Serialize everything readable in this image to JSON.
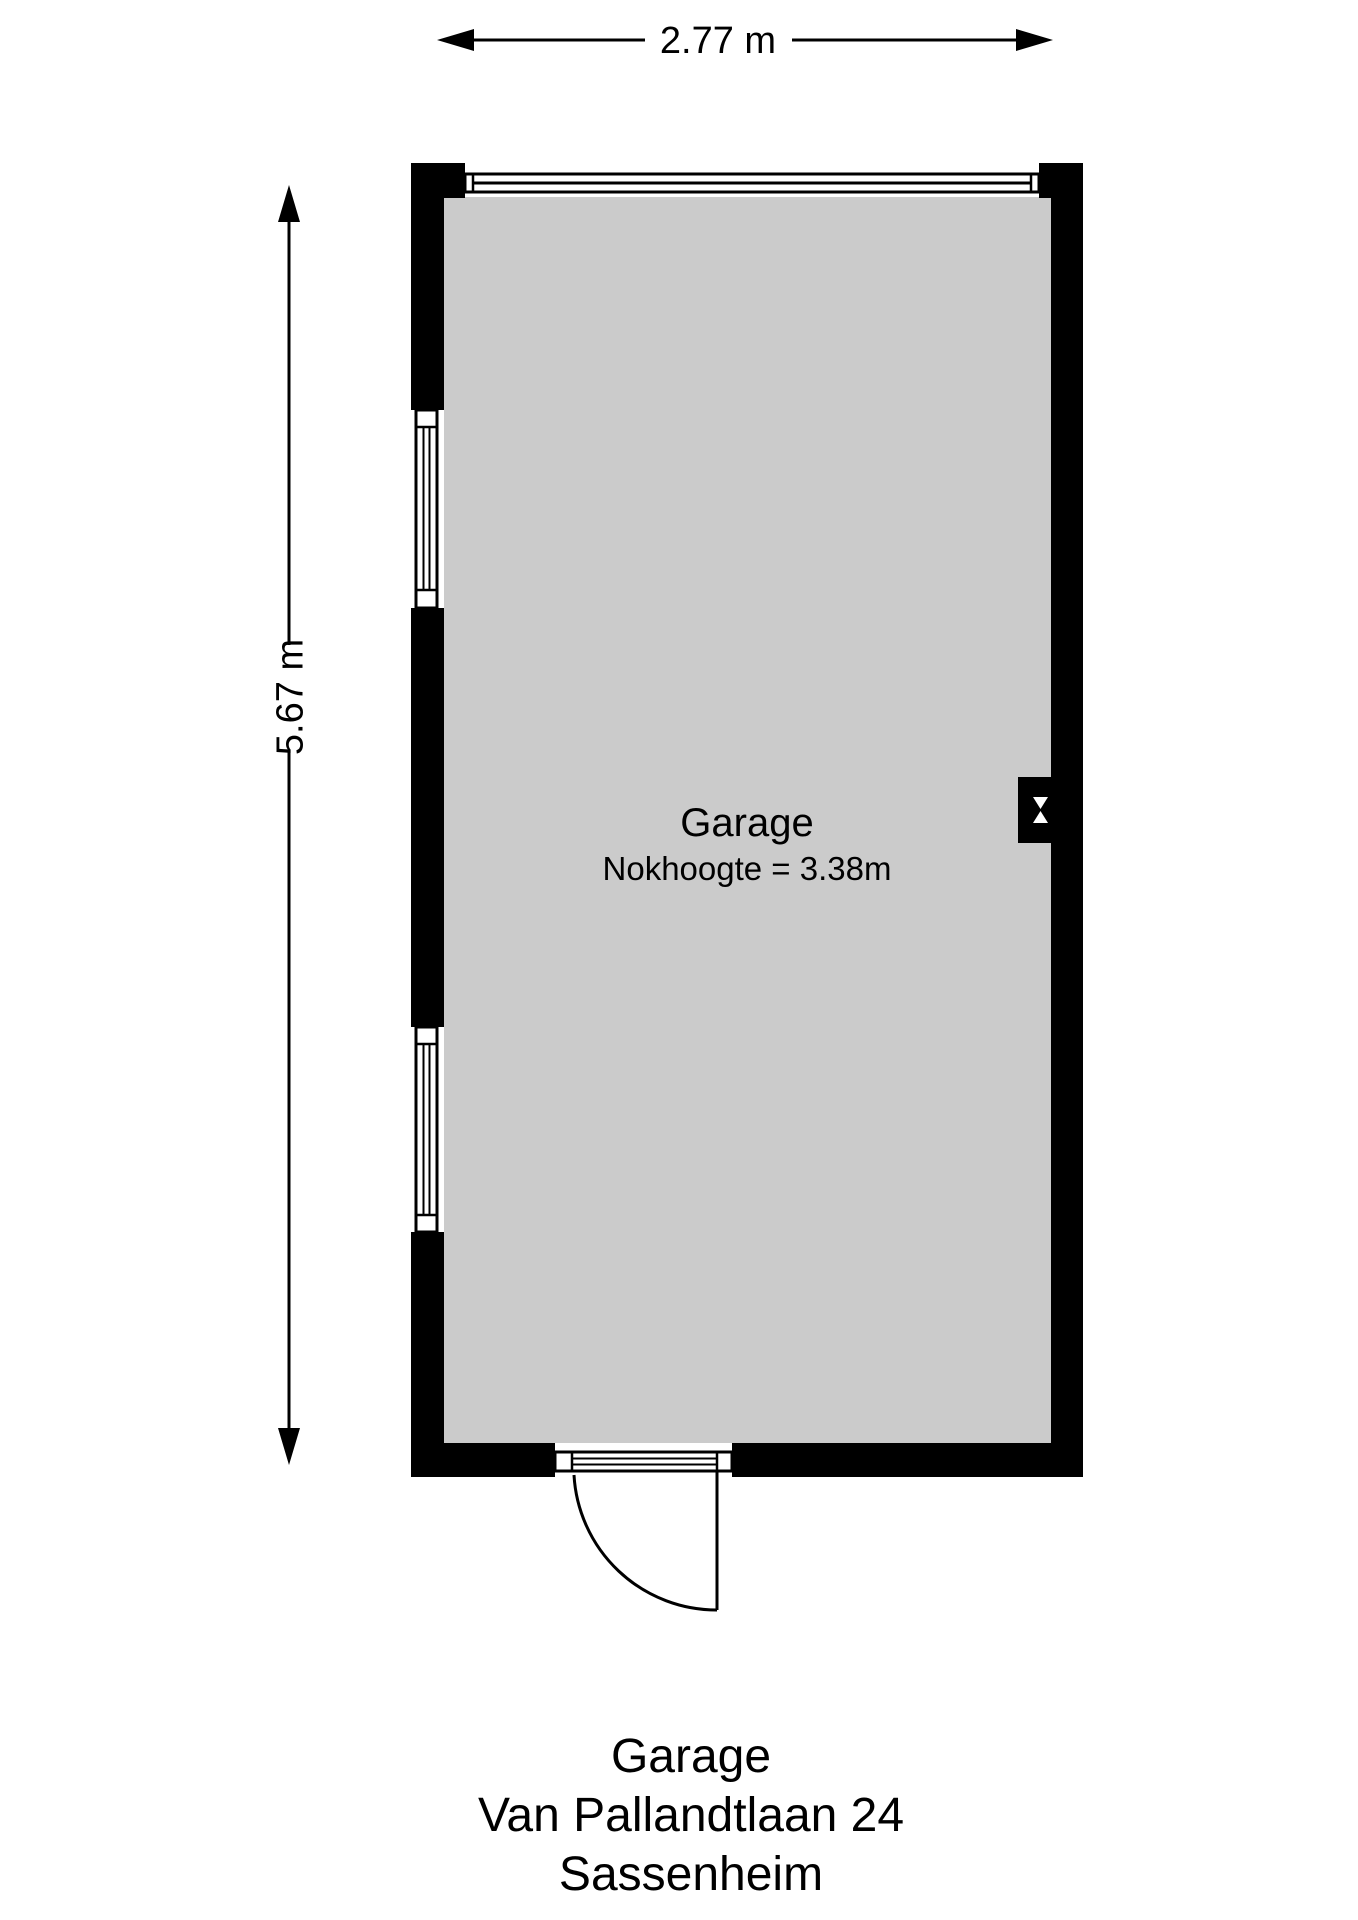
{
  "plan": {
    "room": {
      "name": "Garage",
      "height_note": "Nokhoogte = 3.38m"
    },
    "dimensions": {
      "width": "2.77 m",
      "height": "5.67 m"
    },
    "colors": {
      "wall": "#000000",
      "floor": "#cbcbcb",
      "line": "#000000"
    },
    "features": [
      {
        "name": "top-window"
      },
      {
        "name": "left-window-upper"
      },
      {
        "name": "left-window-lower"
      },
      {
        "name": "entry-door"
      },
      {
        "name": "ventilation-symbol"
      }
    ]
  },
  "title": {
    "line1": "Garage",
    "line2": "Van Pallandtlaan 24",
    "line3": "Sassenheim"
  }
}
